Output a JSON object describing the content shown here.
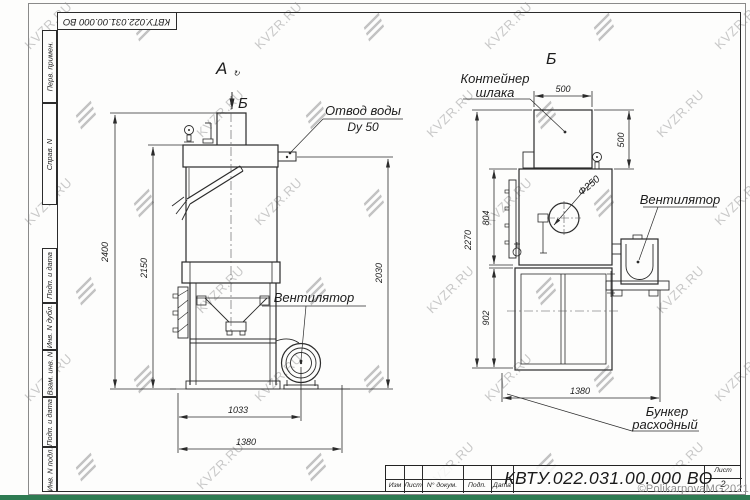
{
  "sheet": {
    "top_stamp": "КВТУ.022.031.00.000  ВО",
    "margin_fields": [
      "Перв. примен.",
      "Справ. N",
      "Подп. и дата",
      "Инв. N дубл.",
      "Взам. инв. N",
      "Подп. и дата",
      "Инв. N подл."
    ]
  },
  "watermark": {
    "text": "KVZR.RU"
  },
  "copyright": "©PolikarpovaMG2021",
  "colors": {
    "line": "#2b2b2b",
    "watermark_grey": "#bcbcbc",
    "bottom_bar_green": "#2e7b52",
    "copyright_grey": "#8f8f8f"
  },
  "view_a": {
    "label": "А",
    "rotation_mark": "↻",
    "section_label": "Б",
    "callout_water_1": "Отвод воды",
    "callout_water_2": "Dy 50",
    "callout_fan": "Вентилятор",
    "dim_total_height": "2400",
    "dim_body_height": "2150",
    "dim_outlet_height": "2030",
    "dim_width_inner": "1033",
    "dim_width_total": "1380"
  },
  "view_b": {
    "label": "Б",
    "callout_container_1": "Контейнер",
    "callout_container_2": "шлака",
    "callout_fan": "Вентилятор",
    "callout_hopper_1": "Бункер",
    "callout_hopper_2": "расходный",
    "dim_diameter": "Ф250",
    "dim_container_w": "500",
    "dim_container_h": "500",
    "dim_body_height": "804",
    "dim_total_height": "2270",
    "dim_hopper_height": "902",
    "dim_width_total": "1380"
  },
  "title_block": {
    "doc_number": "КВТУ.022.031.00.000  ВО",
    "col_izm": "Изм",
    "col_list": "Лист",
    "col_doc": "N° докум.",
    "col_podp": "Подп.",
    "col_data": "Дата",
    "sheet_label": "Лист",
    "sheet_number": "2"
  }
}
